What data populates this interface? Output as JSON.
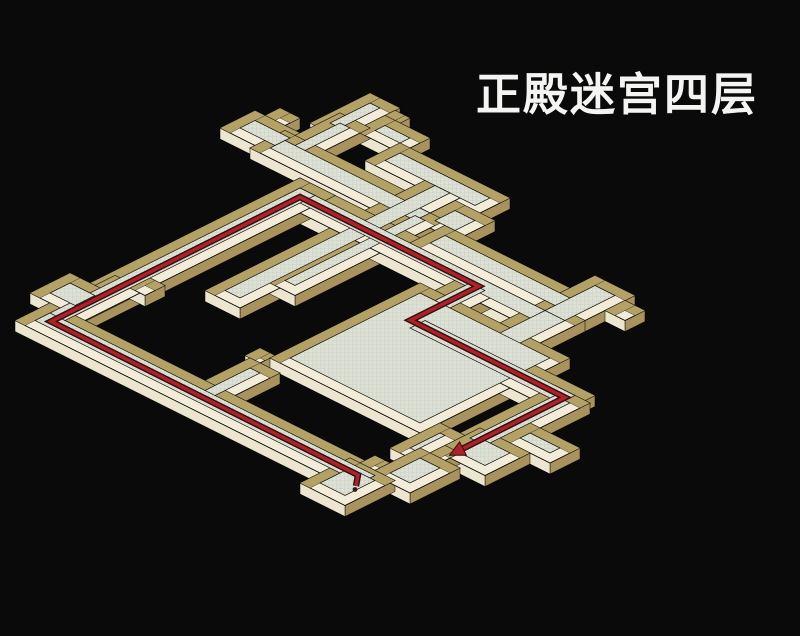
{
  "title": "正殿迷宫四层",
  "map": {
    "background": "#0a0a0a",
    "colors": {
      "wallTop": "#f2ecd9",
      "wallTopFar": "#b3a166",
      "faceSE": "#a8935e",
      "faceSW": "#ece5d0",
      "floor": "#dde1d5",
      "floorLine": "#aab0a0",
      "outline": "#000000",
      "route": "#ae2128",
      "routeEdge": "#2e0f0e",
      "startDot": "#2c2117"
    },
    "iso": {
      "ox": 400,
      "oy": 78,
      "ux": 10,
      "uy": 5,
      "wallHeight": 11,
      "wallThickness": 1
    },
    "pieces": [
      {
        "name": "room-topleft",
        "x": -4,
        "y": 10.5,
        "w": 5.5,
        "h": 3.5
      },
      {
        "name": "room-topleft-nub",
        "x": -3,
        "y": 9,
        "w": 2,
        "h": 1.5
      },
      {
        "name": "room-top",
        "x": 0,
        "y": 3,
        "w": 3,
        "h": 6
      },
      {
        "name": "room-top-nub",
        "x": 3,
        "y": 3.5,
        "w": 1.5,
        "h": 2
      },
      {
        "name": "stub-top",
        "x": 0.5,
        "y": 6.5,
        "w": 3,
        "h": 7
      },
      {
        "name": "corridor-north",
        "x": -0.5,
        "y": 11,
        "w": 16.5,
        "h": 3.5
      },
      {
        "name": "connector-top",
        "x": 3,
        "y": 4.5,
        "w": 4.5,
        "h": 3
      },
      {
        "name": "corridor-upper-right",
        "x": 6.5,
        "y": 6.5,
        "w": 11,
        "h": 3.5
      },
      {
        "name": "steps-right",
        "x": 15,
        "y": 9.5,
        "w": 4,
        "h": 4
      },
      {
        "name": "corridor-bridge",
        "x": 17,
        "y": 12.5,
        "w": 15,
        "h": 3.5
      },
      {
        "name": "crosser-west",
        "x": 11.5,
        "y": 8,
        "w": 3.5,
        "h": 23
      },
      {
        "name": "crosser-east",
        "x": 13.5,
        "y": 12,
        "w": 3,
        "h": 15
      },
      {
        "name": "corridor-red-se",
        "x": 5,
        "y": 15,
        "w": 27,
        "h": 3.5
      },
      {
        "name": "corridor-red-sw",
        "x": 5,
        "y": 15,
        "w": 3.5,
        "h": 27.5
      },
      {
        "name": "rooms-west",
        "x": 3,
        "y": 36,
        "w": 4.5,
        "h": 4
      },
      {
        "name": "west-step-1",
        "x": 5.5,
        "y": 34,
        "w": 2,
        "h": 2
      },
      {
        "name": "west-step-2",
        "x": 7,
        "y": 32.5,
        "w": 2,
        "h": 2
      },
      {
        "name": "corridor-return",
        "x": 5,
        "y": 40,
        "w": 34.5,
        "h": 3.5
      },
      {
        "name": "room-terminal",
        "x": 35.5,
        "y": 40.5,
        "w": 4.5,
        "h": 5
      },
      {
        "name": "room-terminal-nub",
        "x": 36.5,
        "y": 39,
        "w": 1.5,
        "h": 1.5
      },
      {
        "name": "hall-main",
        "x": 21.5,
        "y": 19.5,
        "w": 15,
        "h": 15
      },
      {
        "name": "hall-annex",
        "x": 20.5,
        "y": 35.5,
        "w": 3,
        "h": 7
      },
      {
        "name": "hall-annex-nub",
        "x": 20,
        "y": 34,
        "w": 1.5,
        "h": 1.5
      },
      {
        "name": "room-east",
        "x": 29.5,
        "y": 10,
        "w": 4,
        "h": 7.5
      },
      {
        "name": "room-east-nub",
        "x": 33.5,
        "y": 11,
        "w": 2,
        "h": 2
      },
      {
        "name": "corridor-east",
        "x": 29.5,
        "y": 15,
        "w": 4,
        "h": 9.5
      },
      {
        "name": "descender",
        "x": 23,
        "y": 16,
        "w": 3.5,
        "h": 8.5
      },
      {
        "name": "corridor-lower-se",
        "x": 24.5,
        "y": 22,
        "w": 17,
        "h": 3.5
      },
      {
        "name": "corridor-to-exit",
        "x": 38.5,
        "y": 23,
        "w": 3.5,
        "h": 10.5
      },
      {
        "name": "room-exit",
        "x": 39,
        "y": 31,
        "w": 5,
        "h": 4.5
      },
      {
        "name": "room-exit-east",
        "x": 41,
        "y": 28,
        "w": 5,
        "h": 3
      },
      {
        "name": "room-bottom",
        "x": 38,
        "y": 36,
        "w": 4,
        "h": 5
      },
      {
        "name": "room-bottom-stem",
        "x": 36.5,
        "y": 32.5,
        "w": 2.5,
        "h": 5
      },
      {
        "name": "room-bottom-nub",
        "x": 39,
        "y": 34.5,
        "w": 1.5,
        "h": 1.5
      }
    ],
    "route": {
      "points": [
        [
          38.6,
          43.0
        ],
        [
          37.6,
          41.8
        ],
        [
          6.9,
          41.8
        ],
        [
          6.9,
          16.9
        ],
        [
          24.75,
          16.9
        ],
        [
          24.75,
          23.7
        ],
        [
          40.2,
          23.7
        ],
        [
          40.2,
          33.9
        ]
      ],
      "start_dot": [
        38.9,
        43.4
      ],
      "arrow": true
    }
  }
}
